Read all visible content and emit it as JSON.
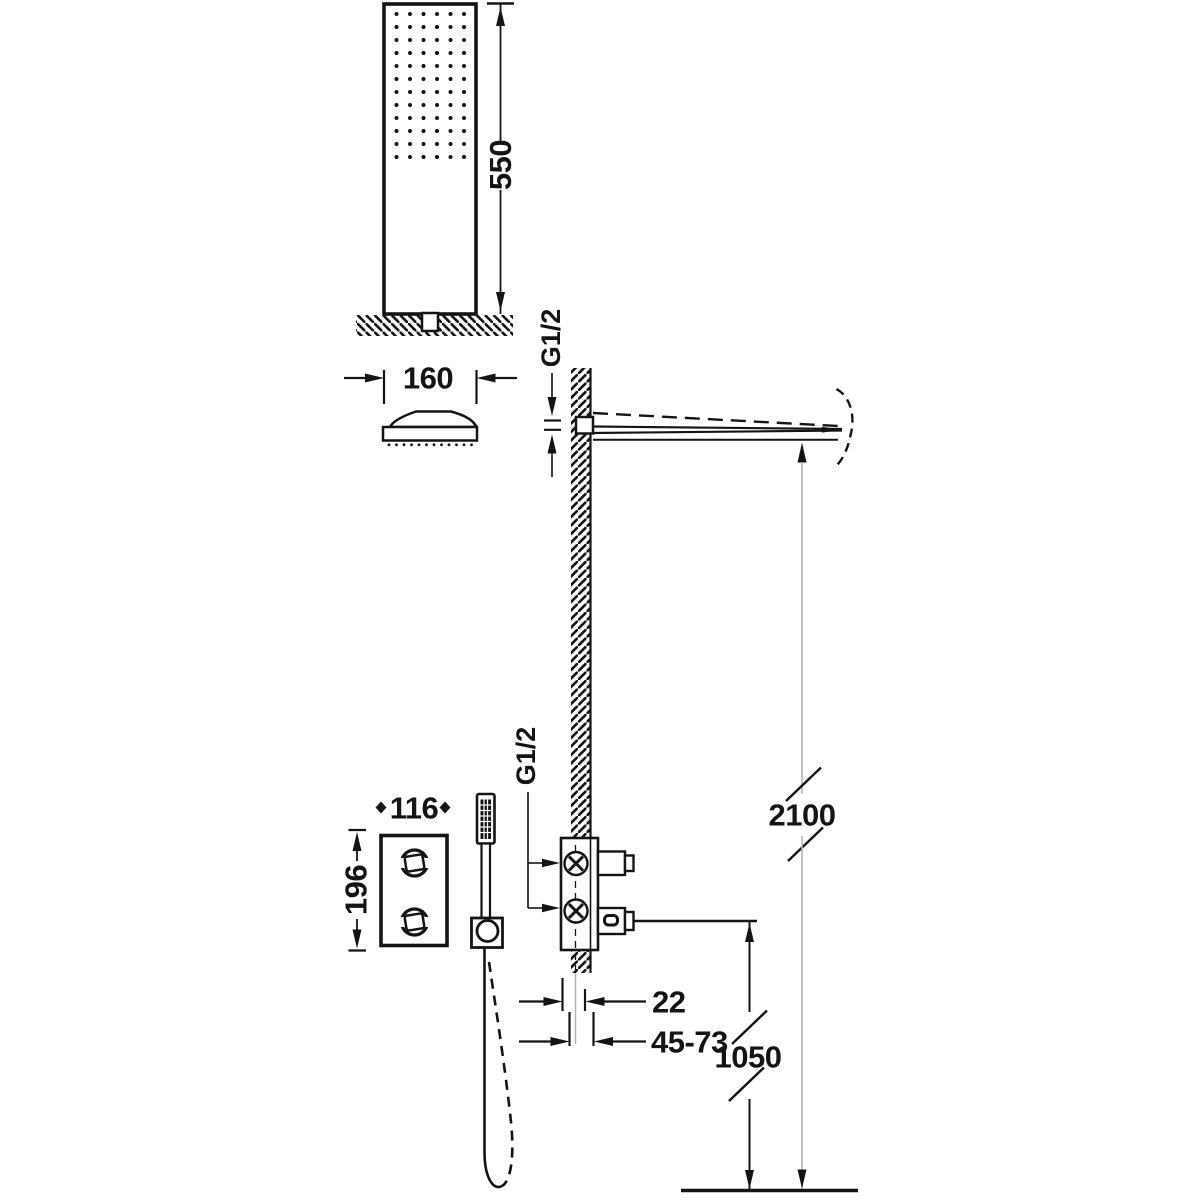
{
  "title": "Concealed thermostatic shower set installation drawing",
  "colors": {
    "ink": "#141414",
    "reference_line": "#b3b3b3",
    "background": "#ffffff"
  },
  "components": {
    "head_front_view": {
      "height_label": "550",
      "spray_grid": {
        "cols": 6,
        "rows": 12
      }
    },
    "head_profile_view": {
      "width_label": "160",
      "base_dots": 12
    },
    "wall_arm": {
      "thread_label": "G1/2",
      "height_label": "2100"
    },
    "control_panel": {
      "width_label": "116",
      "height_label": "196"
    },
    "concealed_mixer": {
      "thread_label": "G1/2",
      "wall_depth_label": "22",
      "adjust_depth_label": "45-73",
      "height_label": "1050"
    }
  }
}
